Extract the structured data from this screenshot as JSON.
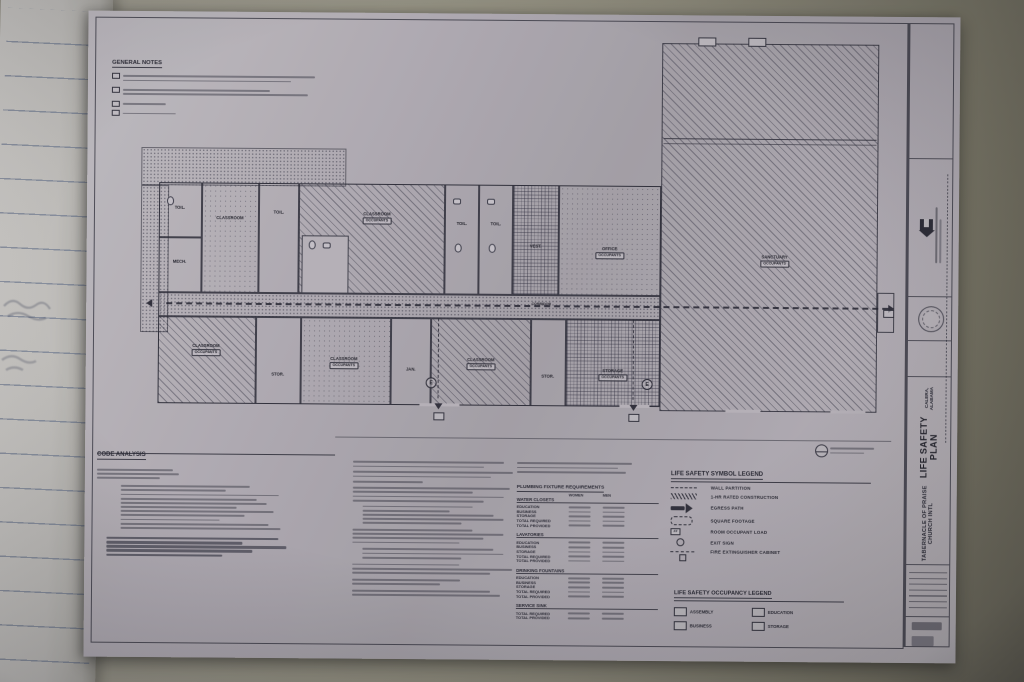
{
  "photo": {
    "surface": "#8e8b7a",
    "sheet_paper": "#b3aeb5",
    "ink": "#34343f"
  },
  "sheet": {
    "general_notes": {
      "title": "GENERAL NOTES"
    },
    "code_analysis": {
      "title": "CODE ANALYSIS"
    },
    "plumbing": {
      "title": "PLUMBING FIXTURE REQUIREMENTS",
      "columns": [
        "WOMEN",
        "MEN"
      ],
      "sections": [
        {
          "title": "WATER CLOSETS",
          "rows": [
            "EDUCATION",
            "BUSINESS",
            "STORAGE",
            "TOTAL REQUIRED",
            "TOTAL PROVIDED"
          ]
        },
        {
          "title": "LAVATORIES",
          "rows": [
            "EDUCATION",
            "BUSINESS",
            "STORAGE",
            "TOTAL REQUIRED",
            "TOTAL PROVIDED"
          ]
        },
        {
          "title": "DRINKING FOUNTAINS",
          "rows": [
            "EDUCATION",
            "BUSINESS",
            "STORAGE",
            "TOTAL REQUIRED",
            "TOTAL PROVIDED"
          ]
        },
        {
          "title": "SERVICE SINK",
          "rows": [
            "TOTAL REQUIRED",
            "TOTAL PROVIDED"
          ]
        }
      ]
    },
    "symbol_legend": {
      "title": "LIFE SAFETY SYMBOL LEGEND",
      "items": [
        {
          "icon": "wall-partition-symbol",
          "label": "WALL PARTITION"
        },
        {
          "icon": "rated-construction-symbol",
          "label": "1-HR RATED CONSTRUCTION"
        },
        {
          "icon": "egress-path-symbol",
          "label": "EGRESS PATH"
        },
        {
          "icon": "room-area-symbol",
          "label": "SQUARE FOOTAGE"
        },
        {
          "icon": "occupant-load-symbol",
          "label": "ROOM OCCUPANT LOAD",
          "box": "## OCCUPANTS"
        },
        {
          "icon": "exit-sign-symbol",
          "label": "EXIT SIGN"
        },
        {
          "icon": "fire-extinguisher-symbol",
          "label": "FIRE EXTINGUISHER CABINET"
        }
      ]
    },
    "occupancy_legend": {
      "title": "LIFE SAFETY OCCUPANCY LEGEND",
      "items": [
        {
          "swatch": "diag",
          "label": "ASSEMBLY"
        },
        {
          "swatch": "stipple",
          "label": "EDUCATION"
        },
        {
          "swatch": "cross",
          "label": "BUSINESS"
        },
        {
          "swatch": "grid",
          "label": "STORAGE"
        }
      ]
    },
    "plan": {
      "occupants_label": "OCCUPANTS",
      "exit_label": "E",
      "corridor_label": "CORRIDOR",
      "rooms": [
        "TOIL.",
        "CLASSROOM",
        "TOIL.",
        "CLASSROOM",
        "TOIL.",
        "TOIL.",
        "VEST.",
        "OFFICE",
        "CLASSROOM",
        "STOR.",
        "CLASSROOM",
        "JAN.",
        "CLASSROOM",
        "STOR.",
        "STORAGE",
        "SANCTUARY",
        "MECH."
      ]
    },
    "title_block": {
      "project": "TABERNACLE OF PRAISE CHURCH INTL",
      "sheet_title": "LIFE SAFETY PLAN",
      "location": "CALERA, ALABAMA"
    }
  }
}
